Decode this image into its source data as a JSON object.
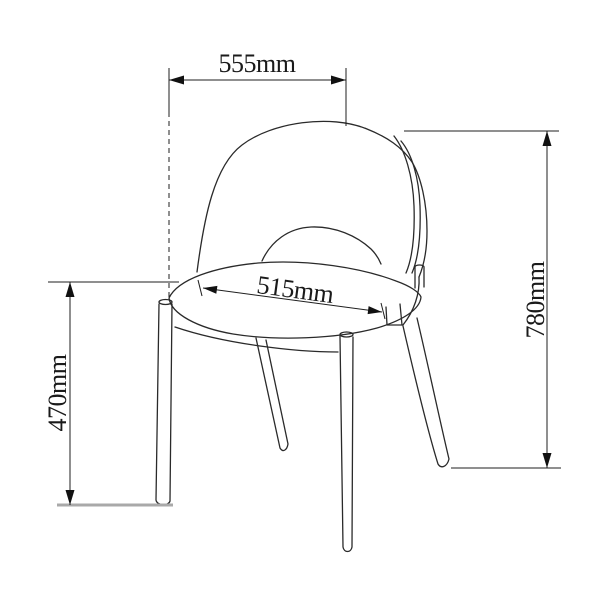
{
  "diagram": {
    "type": "dimensioned technical line drawing",
    "subject": "side chair with curved open-back shell, upholstered seat and four tapered legs",
    "unit": "mm",
    "colors": {
      "line": "#2a2a2a",
      "dimension_line": "#1f1f1f",
      "floor_line": "#a9a9a9",
      "text": "#1a1a1a",
      "background": "#ffffff"
    },
    "dimensions": {
      "overall_width": {
        "label": "555mm",
        "value": 555,
        "unit": "mm",
        "orientation": "horizontal",
        "position": "top"
      },
      "seat_width": {
        "label": "515mm",
        "value": 515,
        "unit": "mm",
        "orientation": "slanted-across-seat",
        "position": "middle"
      },
      "overall_height": {
        "label": "780mm",
        "value": 780,
        "unit": "mm",
        "orientation": "vertical",
        "position": "right"
      },
      "seat_height": {
        "label": "470mm",
        "value": 470,
        "unit": "mm",
        "orientation": "vertical",
        "position": "left"
      }
    }
  }
}
